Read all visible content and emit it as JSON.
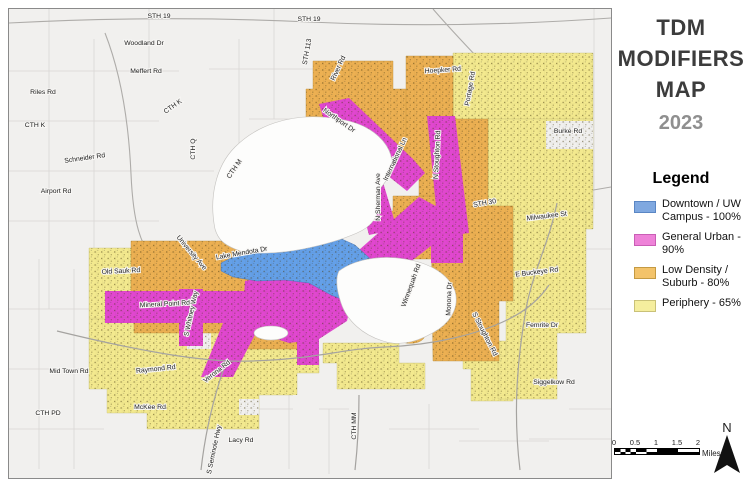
{
  "title": {
    "text": "TDM MODIFIERS MAP",
    "year": "2023"
  },
  "legend": {
    "heading": "Legend",
    "items": [
      {
        "label": "Downtown / UW Campus - 100%",
        "color": "#7fa8e0",
        "border": "#5a86c4"
      },
      {
        "label": "General Urban - 90%",
        "color": "#ee82d8",
        "border": "#c95eb5"
      },
      {
        "label": "Low Density / Suburb - 80%",
        "color": "#f3c36a",
        "border": "#c49a43"
      },
      {
        "label": "Periphery - 65%",
        "color": "#f5ee9e",
        "border": "#c9c178"
      }
    ]
  },
  "scale_bar": {
    "ticks": [
      "0",
      "0.5",
      "1",
      "1.5",
      "2"
    ],
    "unit": "Miles"
  },
  "north_arrow": {
    "label": "N"
  },
  "map": {
    "colors": {
      "land": "#f1f0ee",
      "water": "#fdfdfc",
      "downtown": "#64a0e8",
      "general_urban": "#e147cf",
      "low_density": "#ecb052",
      "periphery": "#f3e98e",
      "road": "#d9d7d4",
      "major_road": "#a9a7a4",
      "border": "#8a8a8a"
    },
    "road_labels": [
      {
        "text": "STH 19",
        "x": 150,
        "y": 9,
        "r": 0
      },
      {
        "text": "STH 19",
        "x": 300,
        "y": 12,
        "r": 0
      },
      {
        "text": "Woodland Dr",
        "x": 135,
        "y": 36,
        "r": 0
      },
      {
        "text": "Meffert Rd",
        "x": 137,
        "y": 64,
        "r": 0
      },
      {
        "text": "Riles Rd",
        "x": 34,
        "y": 85,
        "r": 0
      },
      {
        "text": "CTH K",
        "x": 26,
        "y": 118,
        "r": 0
      },
      {
        "text": "CTH K",
        "x": 165,
        "y": 99,
        "r": -35
      },
      {
        "text": "CTH Q",
        "x": 186,
        "y": 140,
        "r": -90
      },
      {
        "text": "Schneider Rd",
        "x": 76,
        "y": 151,
        "r": -8
      },
      {
        "text": "Airport Rd",
        "x": 47,
        "y": 184,
        "r": 0
      },
      {
        "text": "CTH M",
        "x": 227,
        "y": 161,
        "r": -55
      },
      {
        "text": "STH 113",
        "x": 300,
        "y": 43,
        "r": -80
      },
      {
        "text": "River Rd",
        "x": 331,
        "y": 60,
        "r": -65
      },
      {
        "text": "Hoepker Rd",
        "x": 434,
        "y": 63,
        "r": -4
      },
      {
        "text": "Portage Rd",
        "x": 463,
        "y": 80,
        "r": -80
      },
      {
        "text": "Burke Rd",
        "x": 559,
        "y": 124,
        "r": 0
      },
      {
        "text": "Northport Dr",
        "x": 329,
        "y": 113,
        "r": 35
      },
      {
        "text": "N Sherman Ave",
        "x": 371,
        "y": 188,
        "r": -90
      },
      {
        "text": "International Ln",
        "x": 388,
        "y": 151,
        "r": -65
      },
      {
        "text": "N Stoughton Rd",
        "x": 430,
        "y": 146,
        "r": -87
      },
      {
        "text": "STH 30",
        "x": 476,
        "y": 196,
        "r": -10
      },
      {
        "text": "Milwaukee St",
        "x": 538,
        "y": 209,
        "r": -7
      },
      {
        "text": "Old Sauk Rd",
        "x": 112,
        "y": 264,
        "r": -3
      },
      {
        "text": "University Ave",
        "x": 181,
        "y": 245,
        "r": 50
      },
      {
        "text": "Lake Mendota Dr",
        "x": 233,
        "y": 246,
        "r": -10
      },
      {
        "text": "Mineral Point Rd",
        "x": 156,
        "y": 297,
        "r": -3
      },
      {
        "text": "S Whitney Way",
        "x": 184,
        "y": 305,
        "r": -78
      },
      {
        "text": "Winnequah Rd",
        "x": 404,
        "y": 277,
        "r": -70
      },
      {
        "text": "Monona Dr",
        "x": 442,
        "y": 290,
        "r": -88
      },
      {
        "text": "E Buckeye Rd",
        "x": 528,
        "y": 265,
        "r": -7
      },
      {
        "text": "Femrite Dr",
        "x": 533,
        "y": 318,
        "r": 0
      },
      {
        "text": "Siggelkow Rd",
        "x": 545,
        "y": 375,
        "r": 0
      },
      {
        "text": "S Stoughton Rd",
        "x": 474,
        "y": 326,
        "r": 63
      },
      {
        "text": "Verona Rd",
        "x": 209,
        "y": 364,
        "r": -38
      },
      {
        "text": "S Seminole Hwy",
        "x": 207,
        "y": 441,
        "r": -78
      },
      {
        "text": "Lacy Rd",
        "x": 232,
        "y": 433,
        "r": 0
      },
      {
        "text": "CTH MM",
        "x": 347,
        "y": 417,
        "r": -90
      },
      {
        "text": "CTH PD",
        "x": 39,
        "y": 406,
        "r": 0
      },
      {
        "text": "Mid Town Rd",
        "x": 60,
        "y": 364,
        "r": 0
      },
      {
        "text": "Raymond Rd",
        "x": 147,
        "y": 362,
        "r": -6
      },
      {
        "text": "McKee Rd",
        "x": 141,
        "y": 400,
        "r": 0
      }
    ]
  }
}
